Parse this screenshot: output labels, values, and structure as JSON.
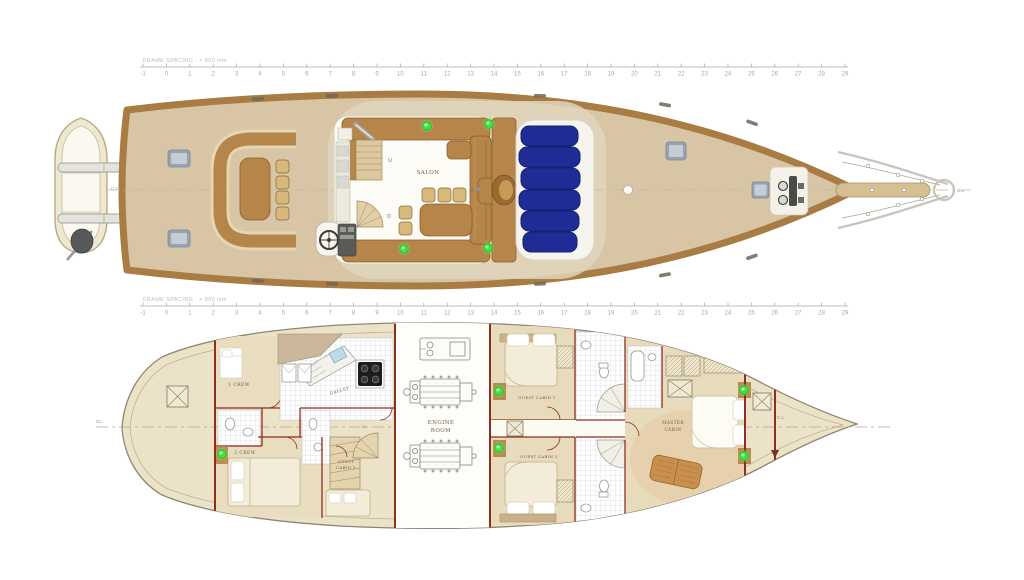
{
  "rulers": {
    "label": "FRAME SPACING : + 900 mm",
    "start": -1,
    "end": 29
  },
  "upper_deck": {
    "salon": "SALON",
    "stair_up": "U",
    "stair_down": "D",
    "door": "D",
    "cl_aft": "C.L.",
    "cl_bow": "C.L."
  },
  "lower_deck": {
    "storage": [
      "ST. GR.",
      "&",
      "STORAGE"
    ],
    "crew1": "1 CREW",
    "crew2": "2 CREW",
    "galley": "GALLEY",
    "stair_up": "U",
    "guest_cabin_3": [
      "GUEST",
      "CABIN 3"
    ],
    "engine_room": [
      "ENGINE",
      "ROOM"
    ],
    "guest_cabin_1": "GUEST CABIN 1",
    "folding_bed": "FOLDING BED",
    "guest_cabin_2": "GUEST CABIN 2",
    "master_cabin": [
      "MASTER",
      "CABIN"
    ],
    "store": "STORE",
    "cl_bow": "C.L.",
    "cl_aft": "CL."
  },
  "colors": {
    "caprail": "#a87c42",
    "deck": "#d7c5a6",
    "side_deck": "#e1d5bc",
    "furniture": "#b5854a",
    "sunpad": "#1f2c95",
    "wall": "#8c2f1e",
    "green_dot": "#3fe43f",
    "hull_lower": "#ece2c8",
    "cabin_floor": "#e8dbbc",
    "tile_line": "#c9cdd9",
    "ruler": "#a6a6a6",
    "text": "#6f5e48",
    "engine_line": "#8a8a80"
  }
}
